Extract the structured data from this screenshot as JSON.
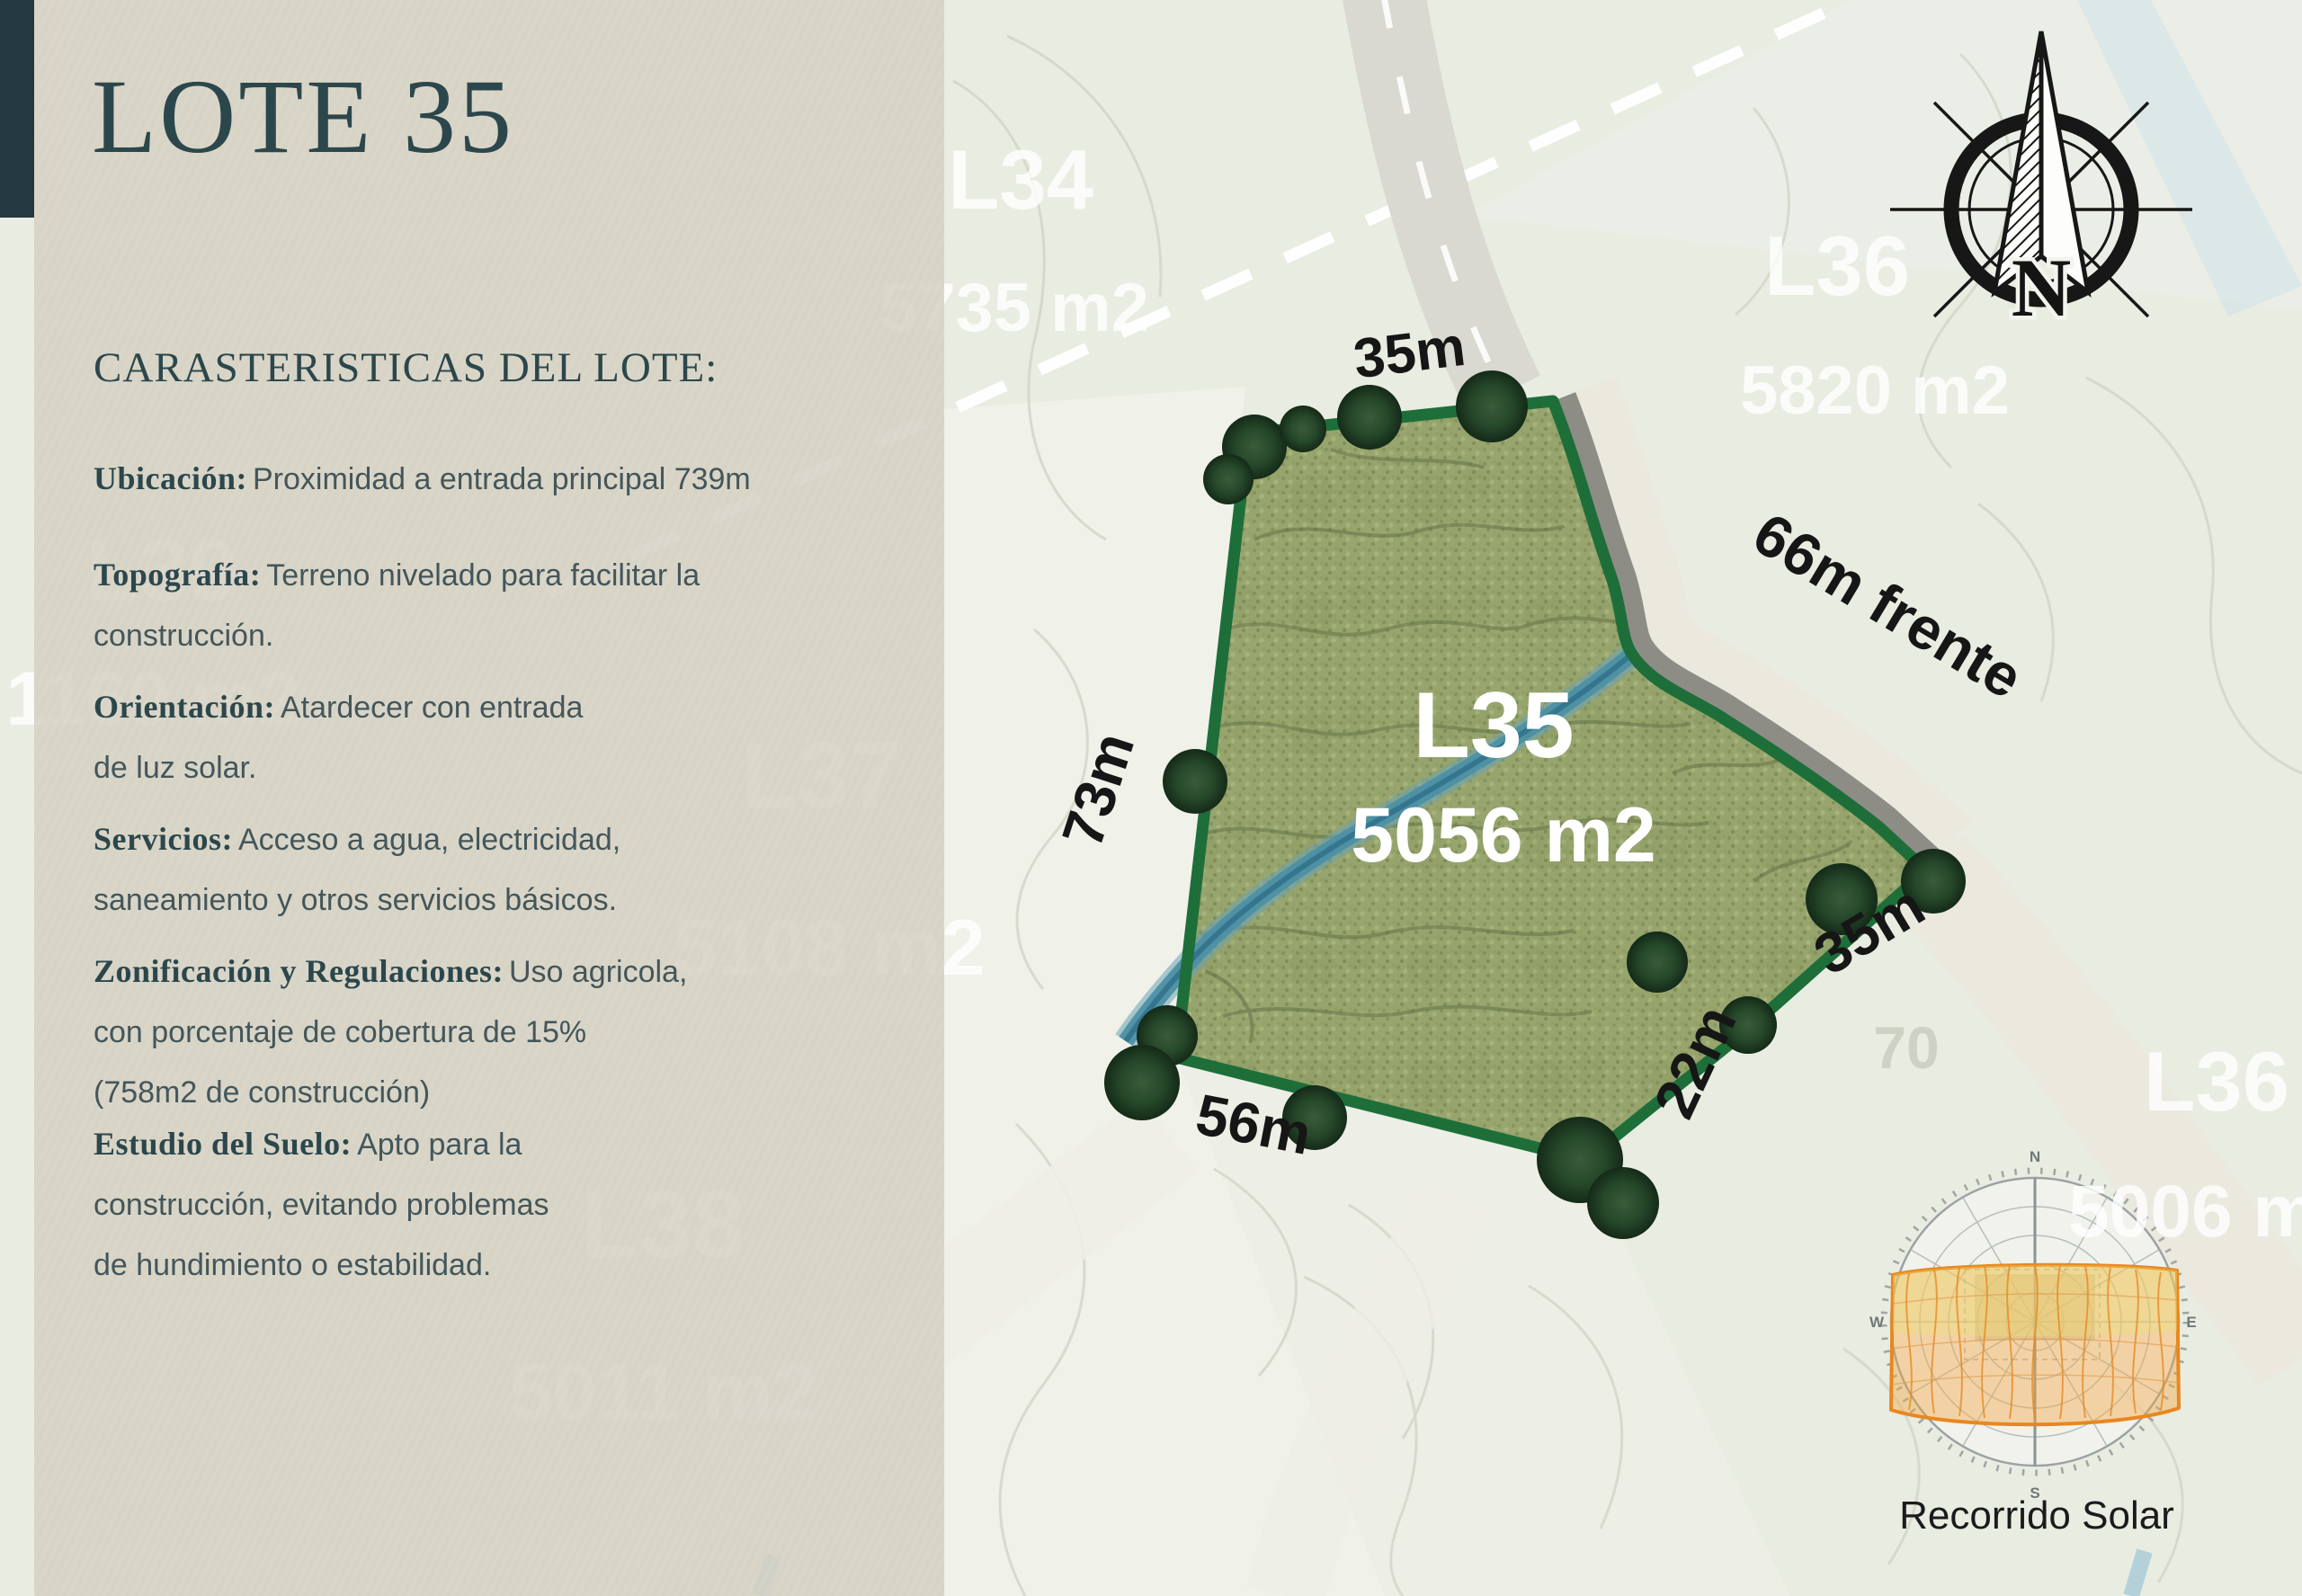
{
  "panel": {
    "title": "LOTE 35",
    "heading": "CARASTERISTICAS DEL LOTE:",
    "features": [
      {
        "label": "Ubicación:",
        "text": "Proximidad a entrada principal 739m"
      },
      {
        "label": "Topografía:",
        "text": "Terreno nivelado para facilitar la\nconstrucción."
      },
      {
        "label": "Orientación:",
        "text": "Atardecer con entrada\nde luz solar."
      },
      {
        "label": "Servicios:",
        "text": "Acceso a agua, electricidad,\nsaneamiento y otros servicios básicos."
      },
      {
        "label": "Zonificación y Regulaciones:",
        "text": "Uso agricola,\ncon porcentaje de cobertura de 15%\n(758m2 de construcción)"
      },
      {
        "label": "Estudio del Suelo:",
        "text": "Apto para la\nconstrucción, evitando problemas\nde hundimiento o estabilidad."
      }
    ]
  },
  "map": {
    "lot_label": "L35",
    "lot_area": "5056 m2",
    "measurements": {
      "top": "35m",
      "frente": "66m frente",
      "left": "73m",
      "bottom": "56m",
      "diag22": "22m",
      "diag35": "35m"
    },
    "neighbors": {
      "l34": {
        "id": "L34",
        "area": "5735 m2"
      },
      "l36_top": {
        "id": "L36",
        "area": "5820 m2"
      },
      "l37": {
        "id": "L37",
        "area": "5108 m2"
      },
      "l38": {
        "id": "L38",
        "area": "5011 m2"
      },
      "l39": {
        "id": "L39",
        "area": "1160 m2"
      },
      "l36_bottom": {
        "id": "L36",
        "area": "5006 m2"
      }
    },
    "elevation_label": "70",
    "compass_letter": "N",
    "sun": {
      "caption": "Recorrido Solar",
      "cardinals": [
        "N",
        "E",
        "S",
        "W"
      ]
    }
  },
  "colors": {
    "accent_teal": "#24393f",
    "ink": "#2c474c",
    "panel_bg": "#d4cfc1",
    "lot_fill": "#97a46d",
    "lot_border": "#1e6e3a",
    "road_gray": "#8d8d86",
    "stream_blue": "#4d90a5",
    "sun_orange": "#e8871f"
  }
}
